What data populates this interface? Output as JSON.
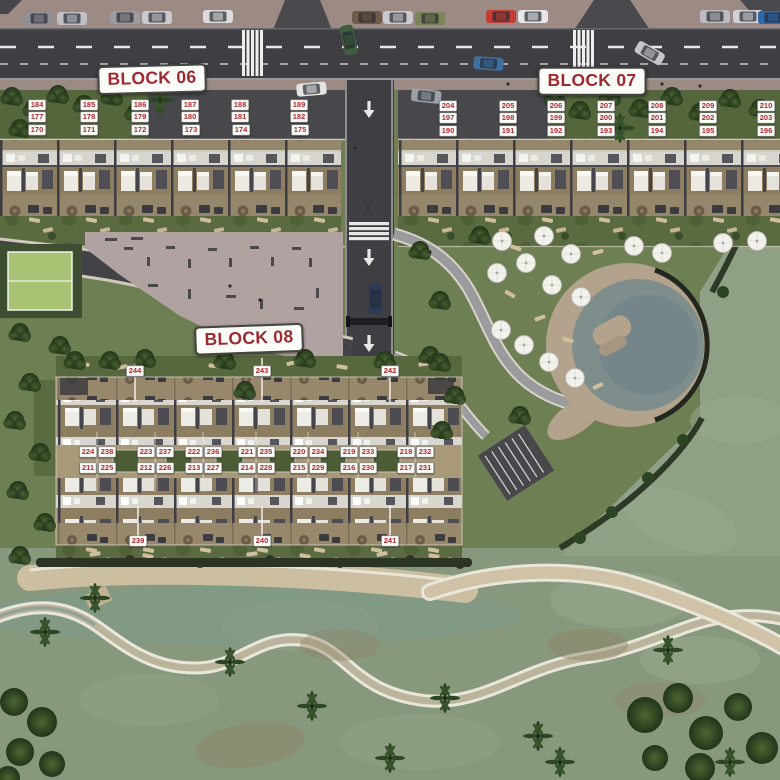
{
  "title": "Residential masterplan aerial site plan",
  "signs": [
    {
      "id": "block-06",
      "label": "BLOCK 06",
      "x": 152,
      "y": 79,
      "rotate": -1.5
    },
    {
      "id": "block-07",
      "label": "BLOCK 07",
      "x": 592,
      "y": 81,
      "rotate": 0
    },
    {
      "id": "block-08",
      "label": "BLOCK 08",
      "x": 249,
      "y": 339,
      "rotate": -2
    }
  ],
  "blocks": [
    {
      "id": "block-06",
      "units": [
        {
          "n": "184",
          "x": 37,
          "y": 105
        },
        {
          "n": "185",
          "x": 89,
          "y": 105
        },
        {
          "n": "186",
          "x": 140,
          "y": 105
        },
        {
          "n": "187",
          "x": 190,
          "y": 105
        },
        {
          "n": "188",
          "x": 240,
          "y": 105
        },
        {
          "n": "189",
          "x": 299,
          "y": 105
        },
        {
          "n": "177",
          "x": 37,
          "y": 117
        },
        {
          "n": "178",
          "x": 89,
          "y": 117
        },
        {
          "n": "179",
          "x": 140,
          "y": 117
        },
        {
          "n": "180",
          "x": 190,
          "y": 117
        },
        {
          "n": "181",
          "x": 240,
          "y": 117
        },
        {
          "n": "182",
          "x": 299,
          "y": 117
        },
        {
          "n": "170",
          "x": 37,
          "y": 130
        },
        {
          "n": "171",
          "x": 89,
          "y": 130
        },
        {
          "n": "172",
          "x": 140,
          "y": 130
        },
        {
          "n": "173",
          "x": 191,
          "y": 130
        },
        {
          "n": "174",
          "x": 241,
          "y": 130
        },
        {
          "n": "175",
          "x": 300,
          "y": 130
        }
      ]
    },
    {
      "id": "block-07",
      "units": [
        {
          "n": "204",
          "x": 448,
          "y": 106
        },
        {
          "n": "205",
          "x": 508,
          "y": 106
        },
        {
          "n": "206",
          "x": 556,
          "y": 106
        },
        {
          "n": "207",
          "x": 606,
          "y": 106
        },
        {
          "n": "208",
          "x": 657,
          "y": 106
        },
        {
          "n": "209",
          "x": 708,
          "y": 106
        },
        {
          "n": "210",
          "x": 766,
          "y": 106
        },
        {
          "n": "197",
          "x": 448,
          "y": 118
        },
        {
          "n": "198",
          "x": 508,
          "y": 118
        },
        {
          "n": "199",
          "x": 556,
          "y": 118
        },
        {
          "n": "200",
          "x": 606,
          "y": 118
        },
        {
          "n": "201",
          "x": 657,
          "y": 118
        },
        {
          "n": "202",
          "x": 708,
          "y": 118
        },
        {
          "n": "203",
          "x": 766,
          "y": 118
        },
        {
          "n": "190",
          "x": 448,
          "y": 131
        },
        {
          "n": "191",
          "x": 508,
          "y": 131
        },
        {
          "n": "192",
          "x": 556,
          "y": 131
        },
        {
          "n": "193",
          "x": 606,
          "y": 131
        },
        {
          "n": "194",
          "x": 657,
          "y": 131
        },
        {
          "n": "195",
          "x": 708,
          "y": 131
        },
        {
          "n": "196",
          "x": 766,
          "y": 131
        }
      ]
    },
    {
      "id": "block-08",
      "units": [
        {
          "n": "244",
          "x": 135,
          "y": 371
        },
        {
          "n": "243",
          "x": 262,
          "y": 371
        },
        {
          "n": "242",
          "x": 390,
          "y": 371
        },
        {
          "n": "224",
          "x": 88,
          "y": 452
        },
        {
          "n": "238",
          "x": 106.5,
          "y": 452
        },
        {
          "n": "223",
          "x": 146,
          "y": 452
        },
        {
          "n": "237",
          "x": 164.5,
          "y": 452
        },
        {
          "n": "222",
          "x": 194,
          "y": 452
        },
        {
          "n": "236",
          "x": 212.5,
          "y": 452
        },
        {
          "n": "221",
          "x": 247,
          "y": 452
        },
        {
          "n": "235",
          "x": 265.5,
          "y": 452
        },
        {
          "n": "220",
          "x": 299,
          "y": 452
        },
        {
          "n": "234",
          "x": 317.5,
          "y": 452
        },
        {
          "n": "219",
          "x": 349,
          "y": 452
        },
        {
          "n": "233",
          "x": 367.5,
          "y": 452
        },
        {
          "n": "218",
          "x": 406,
          "y": 452
        },
        {
          "n": "232",
          "x": 424.5,
          "y": 452
        },
        {
          "n": "211",
          "x": 88,
          "y": 468
        },
        {
          "n": "225",
          "x": 106.5,
          "y": 468
        },
        {
          "n": "212",
          "x": 146,
          "y": 468
        },
        {
          "n": "226",
          "x": 164.5,
          "y": 468
        },
        {
          "n": "213",
          "x": 194,
          "y": 468
        },
        {
          "n": "227",
          "x": 212.5,
          "y": 468
        },
        {
          "n": "214",
          "x": 247,
          "y": 468
        },
        {
          "n": "228",
          "x": 265.5,
          "y": 468
        },
        {
          "n": "215",
          "x": 299,
          "y": 468
        },
        {
          "n": "229",
          "x": 317.5,
          "y": 468
        },
        {
          "n": "216",
          "x": 349,
          "y": 468
        },
        {
          "n": "230",
          "x": 367.5,
          "y": 468
        },
        {
          "n": "217",
          "x": 406,
          "y": 468
        },
        {
          "n": "231",
          "x": 424.5,
          "y": 468
        },
        {
          "n": "239",
          "x": 138,
          "y": 541
        },
        {
          "n": "240",
          "x": 262,
          "y": 541
        },
        {
          "n": "241",
          "x": 390,
          "y": 541
        }
      ]
    }
  ],
  "colors": {
    "label_red": "#b2262d",
    "sign_red": "#9f2831",
    "plate_bg": "#fdfdf9",
    "asphalt": "#3e3e43",
    "sidewalk_mauve": "#9c8b85",
    "apron": "#47474c",
    "deck_tan": "#8d7e62",
    "roof_white": "#d7d5ce",
    "garden_green": "#57673e",
    "amenity_green": "#6e7f53",
    "golf_green": "#8fa084",
    "plaza_pink": "#b1a2a2",
    "court_green": "#a9c273",
    "pool_water": "#7d8e8c",
    "pool_deck": "#b3a28c",
    "sand": "#ccbea1",
    "creek_bank": "#e9e7db"
  }
}
